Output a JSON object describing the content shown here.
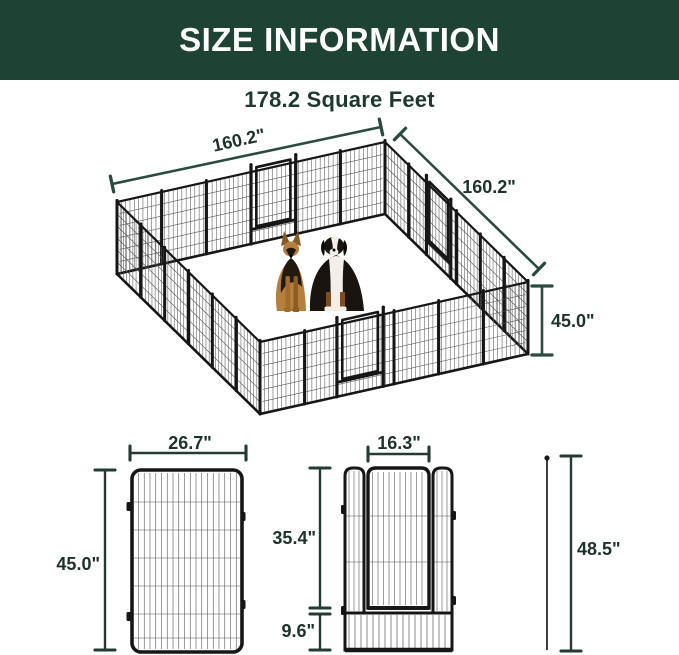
{
  "header": {
    "title": "SIZE INFORMATION"
  },
  "area": {
    "label": "178.2 Square Feet"
  },
  "pen": {
    "edge_left": "160.2\"",
    "edge_right": "160.2\"",
    "height": "45.0\""
  },
  "panel": {
    "width": "26.7\"",
    "height": "45.0\""
  },
  "door": {
    "width": "16.3\"",
    "height": "35.4\"",
    "bottom": "9.6\""
  },
  "stake": {
    "height": "48.5\""
  },
  "colors": {
    "band_bg": "#1e4233",
    "band_text": "#ffffff",
    "subtitle_text": "#1d392e",
    "dim_top": "#2a4c3e",
    "dim_bottom": "#233b31",
    "fence": "#161616",
    "mesh": "#565656"
  }
}
